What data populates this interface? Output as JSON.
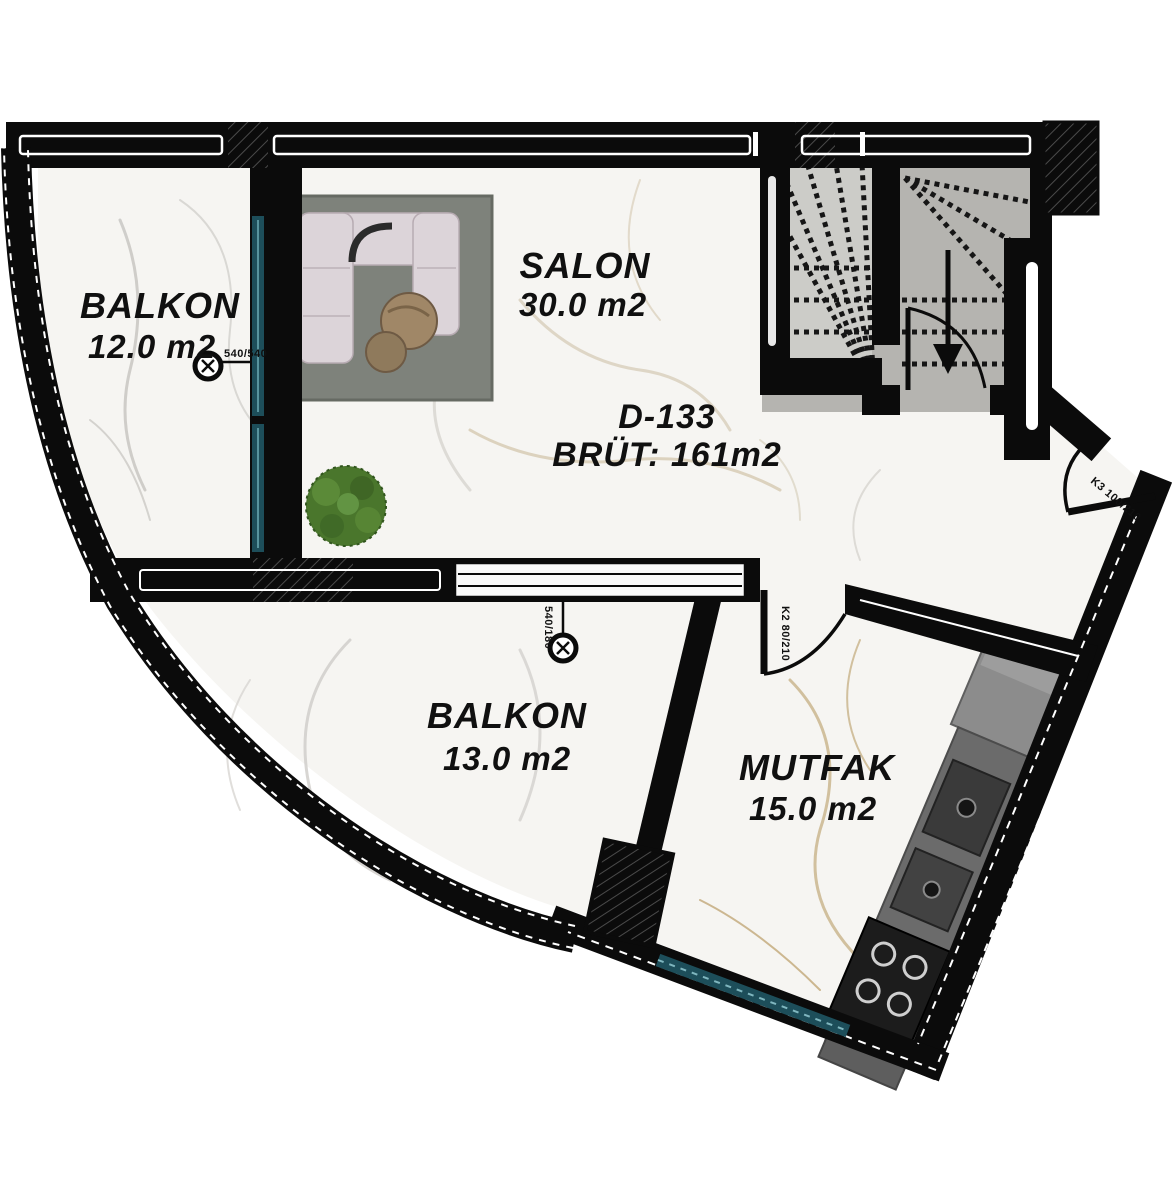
{
  "plan": {
    "unit": {
      "code": "D-133",
      "gross_area": "BRÜT: 161m2"
    },
    "rooms": [
      {
        "id": "balkon-top",
        "name": "BALKON",
        "area": "12.0 m2"
      },
      {
        "id": "salon",
        "name": "SALON",
        "area": "30.0 m2"
      },
      {
        "id": "balkon-bottom",
        "name": "BALKON",
        "area": "13.0 m2"
      },
      {
        "id": "mutfak",
        "name": "MUTFAK",
        "area": "15.0 m2"
      }
    ],
    "markers": {
      "window_balkon_top": "540/540",
      "window_balkon_bottom": "540/180",
      "door_main": "K3 100/210",
      "door_kitchen": "K2 80/210"
    },
    "stair": {
      "direction": "down"
    },
    "colors": {
      "wall": "#0b0b0b",
      "floor": "#f6f5f2",
      "window_glass": "#1d4e5a",
      "window_glass_light": "#58949e",
      "rug": "#7e827b",
      "sofa": "#dcd4d9",
      "sofa_trim": "#b7abb2",
      "table": "#a08767",
      "table_small": "#8f7a5c",
      "plant": "#4a762c",
      "stair_tread": "#b5b4b0",
      "stair_flight": "#ccccc8",
      "counter": "#6b6b6b",
      "fridge": "#8c8c8c",
      "appliance": "#3a3a3a",
      "cooktop": "#1c1c1c",
      "vein_cool": "#c9c7c3",
      "vein_warm": "#c2a878"
    }
  }
}
